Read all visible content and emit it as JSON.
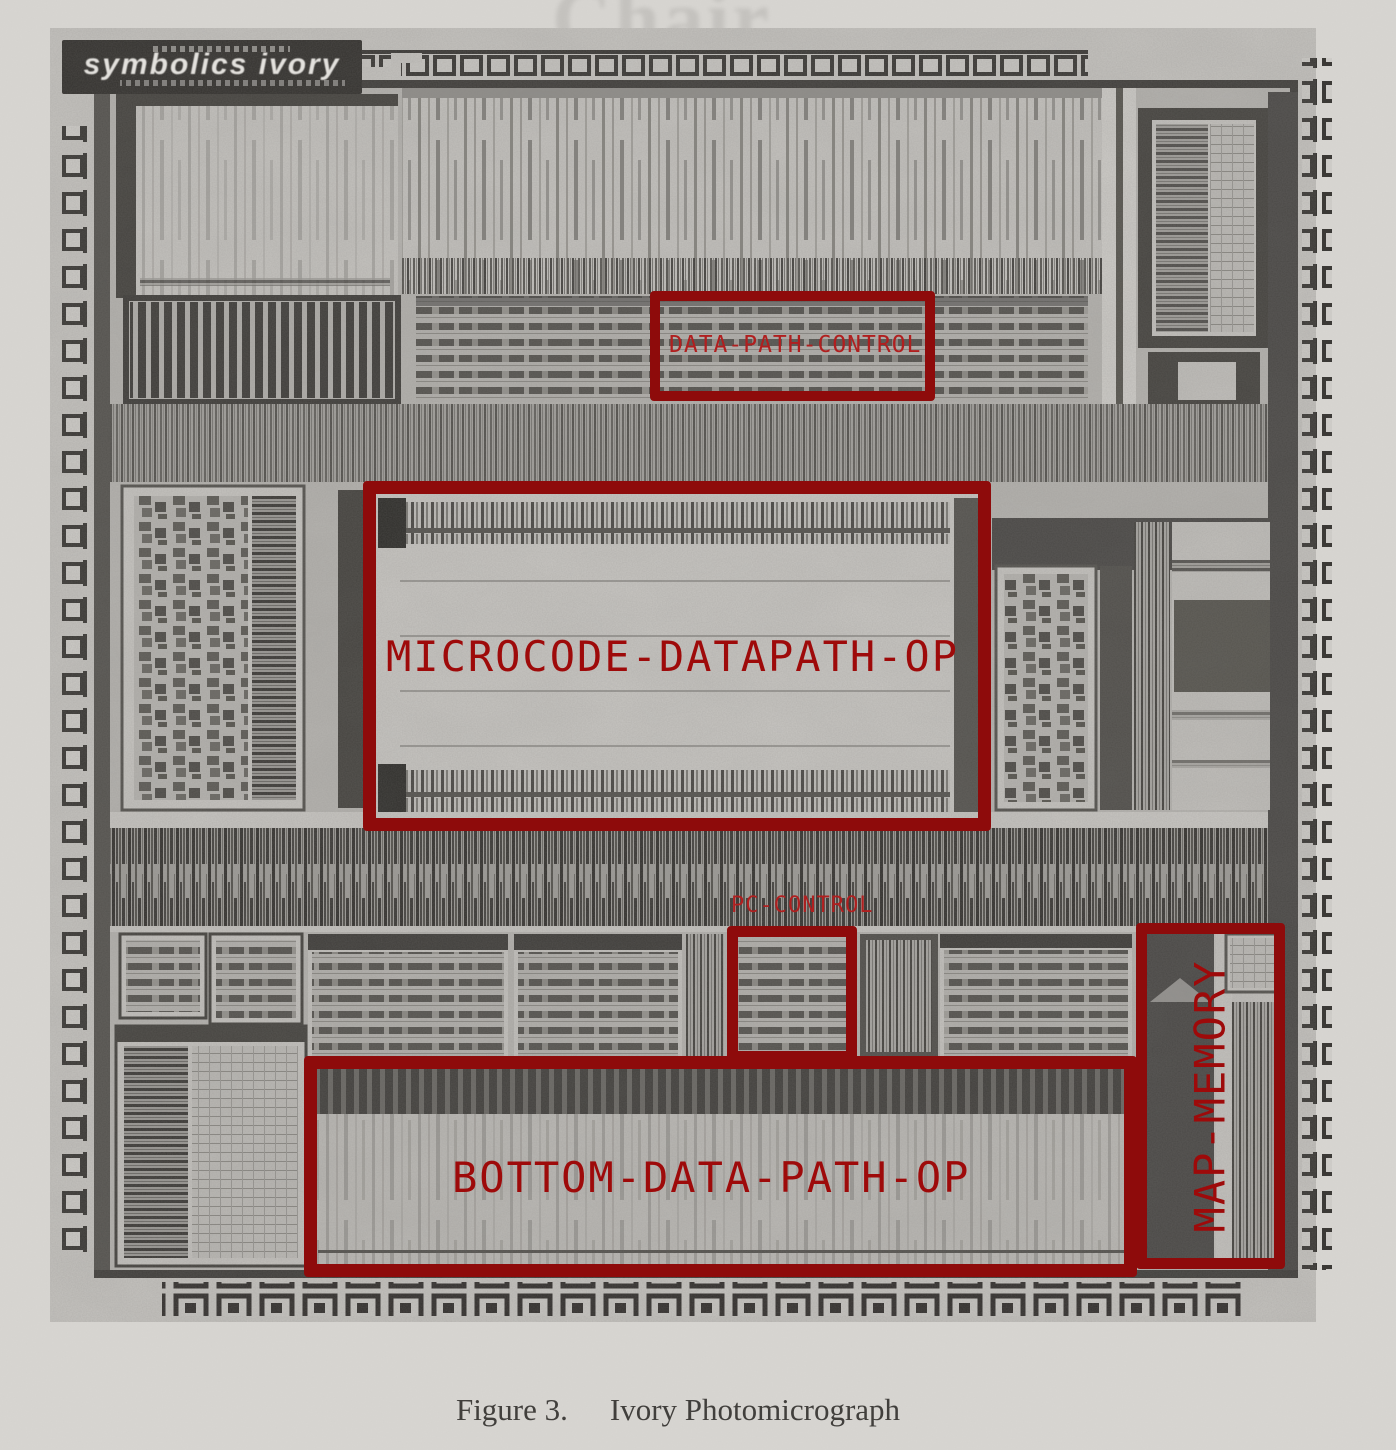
{
  "figure": {
    "caption_prefix": "Figure 3.",
    "caption_title": "Ivory Photomicrograph",
    "ghost_text": "Chair"
  },
  "chip": {
    "logo_text": "symbolics ivory"
  },
  "annotations": {
    "data_path_control": {
      "label": "DATA-PATH-CONTROL"
    },
    "microcode_datapath_op": {
      "label": "MICROCODE-DATAPATH-OP"
    },
    "pc_control": {
      "label": "PC-CONTROL"
    },
    "bottom_data_path_op": {
      "label": "BOTTOM-DATA-PATH-OP"
    },
    "map_memory": {
      "label": "MAP-MEMORY"
    }
  },
  "colors": {
    "page_background": "#d8d6d2",
    "photo_margin": "#c6c4c0",
    "die_base": "#b6b4b0",
    "annotation_border": "#8e0b0b",
    "annotation_text_large": "#9e0a0a",
    "annotation_text_small": "#b01f1f"
  }
}
